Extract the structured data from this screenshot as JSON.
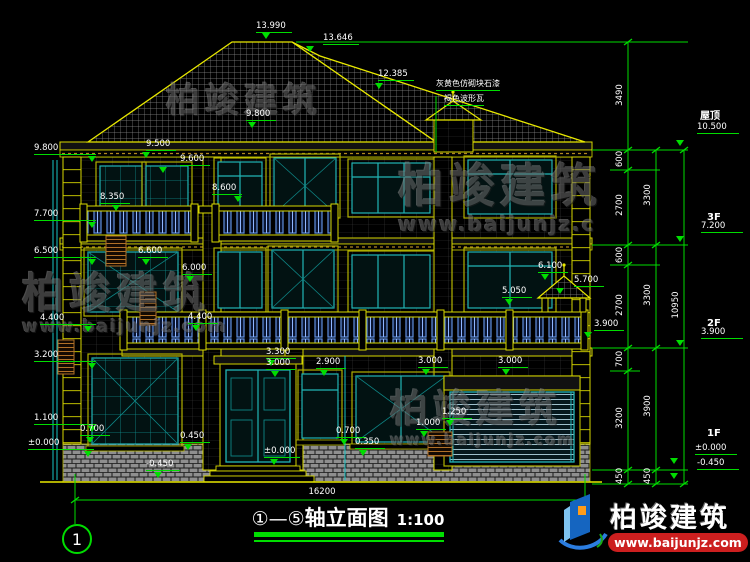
{
  "drawing": {
    "title_axis": "①—⑤",
    "title_name": "轴立面图",
    "title_scale": "1:100",
    "axis_bubble": "1"
  },
  "material_notes": [
    {
      "text": "灰黄色仿砌块石漆",
      "x": 436,
      "y": 78
    },
    {
      "text": "褐色波形瓦",
      "x": 444,
      "y": 93
    }
  ],
  "right_levels": [
    {
      "label": "屋顶",
      "elev": "10.500",
      "label_x": 700,
      "label_y": 107,
      "elev_x": 697,
      "elev_y": 123,
      "tri_x": 680,
      "tri_y": 140
    },
    {
      "label": "3F",
      "elev": "7.200",
      "label_x": 707,
      "label_y": 212,
      "elev_x": 701,
      "elev_y": 222,
      "tri_x": 680,
      "tri_y": 236
    },
    {
      "label": "2F",
      "elev": "3.900",
      "label_x": 707,
      "label_y": 318,
      "elev_x": 701,
      "elev_y": 328,
      "tri_x": 680,
      "tri_y": 340
    },
    {
      "label": "1F",
      "elev": "±0.000",
      "label_x": 707,
      "label_y": 428,
      "elev_x": 695,
      "elev_y": 444,
      "tri_x": 674,
      "tri_y": 458
    },
    {
      "label": "",
      "elev": "-0.450",
      "label_x": 0,
      "label_y": 0,
      "elev_x": 697,
      "elev_y": 459,
      "tri_x": 674,
      "tri_y": 473
    }
  ],
  "elevation_markers": [
    {
      "text": "13.990",
      "x": 256,
      "y": 22,
      "tx": 266,
      "ty": 33,
      "w": 36
    },
    {
      "text": "13.646",
      "x": 323,
      "y": 34,
      "tx": 310,
      "ty": 46,
      "w": 36
    },
    {
      "text": "12.385",
      "x": 378,
      "y": 70,
      "tx": 379,
      "ty": 83,
      "w": 36
    },
    {
      "text": "9.800",
      "x": 246,
      "y": 110,
      "tx": 252,
      "ty": 122,
      "w": 30
    },
    {
      "text": "9.500",
      "x": 146,
      "y": 140,
      "tx": 146,
      "ty": 152,
      "w": 30
    },
    {
      "text": "9.600",
      "x": 180,
      "y": 155,
      "tx": 163,
      "ty": 167,
      "w": 30
    },
    {
      "text": "8.600",
      "x": 212,
      "y": 184,
      "tx": 238,
      "ty": 196,
      "w": 30
    },
    {
      "text": "8.350",
      "x": 100,
      "y": 193,
      "tx": 116,
      "ty": 205,
      "w": 30
    },
    {
      "text": "9.800",
      "x": 34,
      "y": 144,
      "tx": 92,
      "ty": 156,
      "w": 62
    },
    {
      "text": "7.700",
      "x": 34,
      "y": 210,
      "tx": 92,
      "ty": 222,
      "w": 62
    },
    {
      "text": "6.500",
      "x": 34,
      "y": 247,
      "tx": 92,
      "ty": 259,
      "w": 62
    },
    {
      "text": "4.400",
      "x": 40,
      "y": 314,
      "tx": 88,
      "ty": 326,
      "w": 56
    },
    {
      "text": "3.200",
      "x": 34,
      "y": 351,
      "tx": 92,
      "ty": 363,
      "w": 62
    },
    {
      "text": "1.100",
      "x": 34,
      "y": 414,
      "tx": 92,
      "ty": 426,
      "w": 62
    },
    {
      "text": "±0.000",
      "x": 28,
      "y": 439,
      "tx": 88,
      "ty": 451,
      "w": 66
    },
    {
      "text": "0.700",
      "x": 80,
      "y": 425,
      "tx": 90,
      "ty": 437,
      "w": 30
    },
    {
      "text": "0.450",
      "x": 180,
      "y": 432,
      "tx": 188,
      "ty": 444,
      "w": 30
    },
    {
      "text": "-0.450",
      "x": 146,
      "y": 460,
      "tx": 158,
      "ty": 472,
      "w": 34
    },
    {
      "text": "6.600",
      "x": 138,
      "y": 247,
      "tx": 146,
      "ty": 259,
      "w": 30
    },
    {
      "text": "6.000",
      "x": 182,
      "y": 264,
      "tx": 190,
      "ty": 276,
      "w": 30
    },
    {
      "text": "4.400",
      "x": 188,
      "y": 313,
      "tx": 196,
      "ty": 325,
      "w": 30
    },
    {
      "text": "6.100",
      "x": 538,
      "y": 262,
      "tx": 545,
      "ty": 274,
      "w": 30
    },
    {
      "text": "5.700",
      "x": 574,
      "y": 276,
      "tx": 560,
      "ty": 288,
      "w": 30
    },
    {
      "text": "5.050",
      "x": 502,
      "y": 287,
      "tx": 509,
      "ty": 299,
      "w": 30
    },
    {
      "text": "3.900",
      "x": 594,
      "y": 320,
      "tx": 588,
      "ty": 332,
      "w": 30
    },
    {
      "text": "3.300",
      "x": 266,
      "y": 348,
      "tx": 271,
      "ty": 360,
      "w": 30
    },
    {
      "text": "3.000",
      "x": 266,
      "y": 359,
      "tx": 275,
      "ty": 371,
      "w": 30
    },
    {
      "text": "2.900",
      "x": 316,
      "y": 358,
      "tx": 324,
      "ty": 370,
      "w": 30
    },
    {
      "text": "3.000",
      "x": 418,
      "y": 357,
      "tx": 426,
      "ty": 369,
      "w": 30
    },
    {
      "text": "3.000",
      "x": 498,
      "y": 357,
      "tx": 506,
      "ty": 369,
      "w": 30
    },
    {
      "text": "1.250",
      "x": 442,
      "y": 408,
      "tx": 450,
      "ty": 420,
      "w": 30
    },
    {
      "text": "1.000",
      "x": 416,
      "y": 419,
      "tx": 424,
      "ty": 431,
      "w": 30
    },
    {
      "text": "0.700",
      "x": 336,
      "y": 427,
      "tx": 344,
      "ty": 439,
      "w": 30
    },
    {
      "text": "0.350",
      "x": 355,
      "y": 438,
      "tx": 363,
      "ty": 450,
      "w": 30
    },
    {
      "text": "±0.000",
      "x": 264,
      "y": 447,
      "tx": 274,
      "ty": 459,
      "w": 36
    }
  ],
  "dim_texts": [
    {
      "text": "3490",
      "x": 620,
      "y": 95,
      "rot": true
    },
    {
      "text": "600",
      "x": 620,
      "y": 159,
      "rot": true
    },
    {
      "text": "2700",
      "x": 620,
      "y": 205,
      "rot": true
    },
    {
      "text": "600",
      "x": 620,
      "y": 255,
      "rot": true
    },
    {
      "text": "2700",
      "x": 620,
      "y": 305,
      "rot": true
    },
    {
      "text": "700",
      "x": 620,
      "y": 359,
      "rot": true
    },
    {
      "text": "3200",
      "x": 620,
      "y": 418,
      "rot": true
    },
    {
      "text": "450",
      "x": 620,
      "y": 476,
      "rot": true
    },
    {
      "text": "3300",
      "x": 648,
      "y": 195,
      "rot": true
    },
    {
      "text": "3300",
      "x": 648,
      "y": 295,
      "rot": true
    },
    {
      "text": "3900",
      "x": 648,
      "y": 406,
      "rot": true
    },
    {
      "text": "450",
      "x": 648,
      "y": 476,
      "rot": true
    },
    {
      "text": "10950",
      "x": 676,
      "y": 305,
      "rot": true
    },
    {
      "text": "16200",
      "x": 322,
      "y": 492,
      "rot": false
    }
  ],
  "watermarks": [
    {
      "text": "柏竣建筑",
      "url": "",
      "x": 166,
      "y": 82,
      "size": 34,
      "usize": 0
    },
    {
      "text": "柏竣建筑",
      "url": "www.baijunjz.com",
      "x": 22,
      "y": 270,
      "size": 42,
      "usize": 17
    },
    {
      "text": "柏竣建筑",
      "url": "www.baijunjz.c",
      "x": 398,
      "y": 160,
      "size": 46,
      "usize": 20
    },
    {
      "text": "柏竣建筑",
      "url": "www.baijunjz.com",
      "x": 390,
      "y": 388,
      "size": 38,
      "usize": 15
    }
  ],
  "logo": {
    "name": "柏竣建筑",
    "url": "www.baijunjz.com"
  }
}
